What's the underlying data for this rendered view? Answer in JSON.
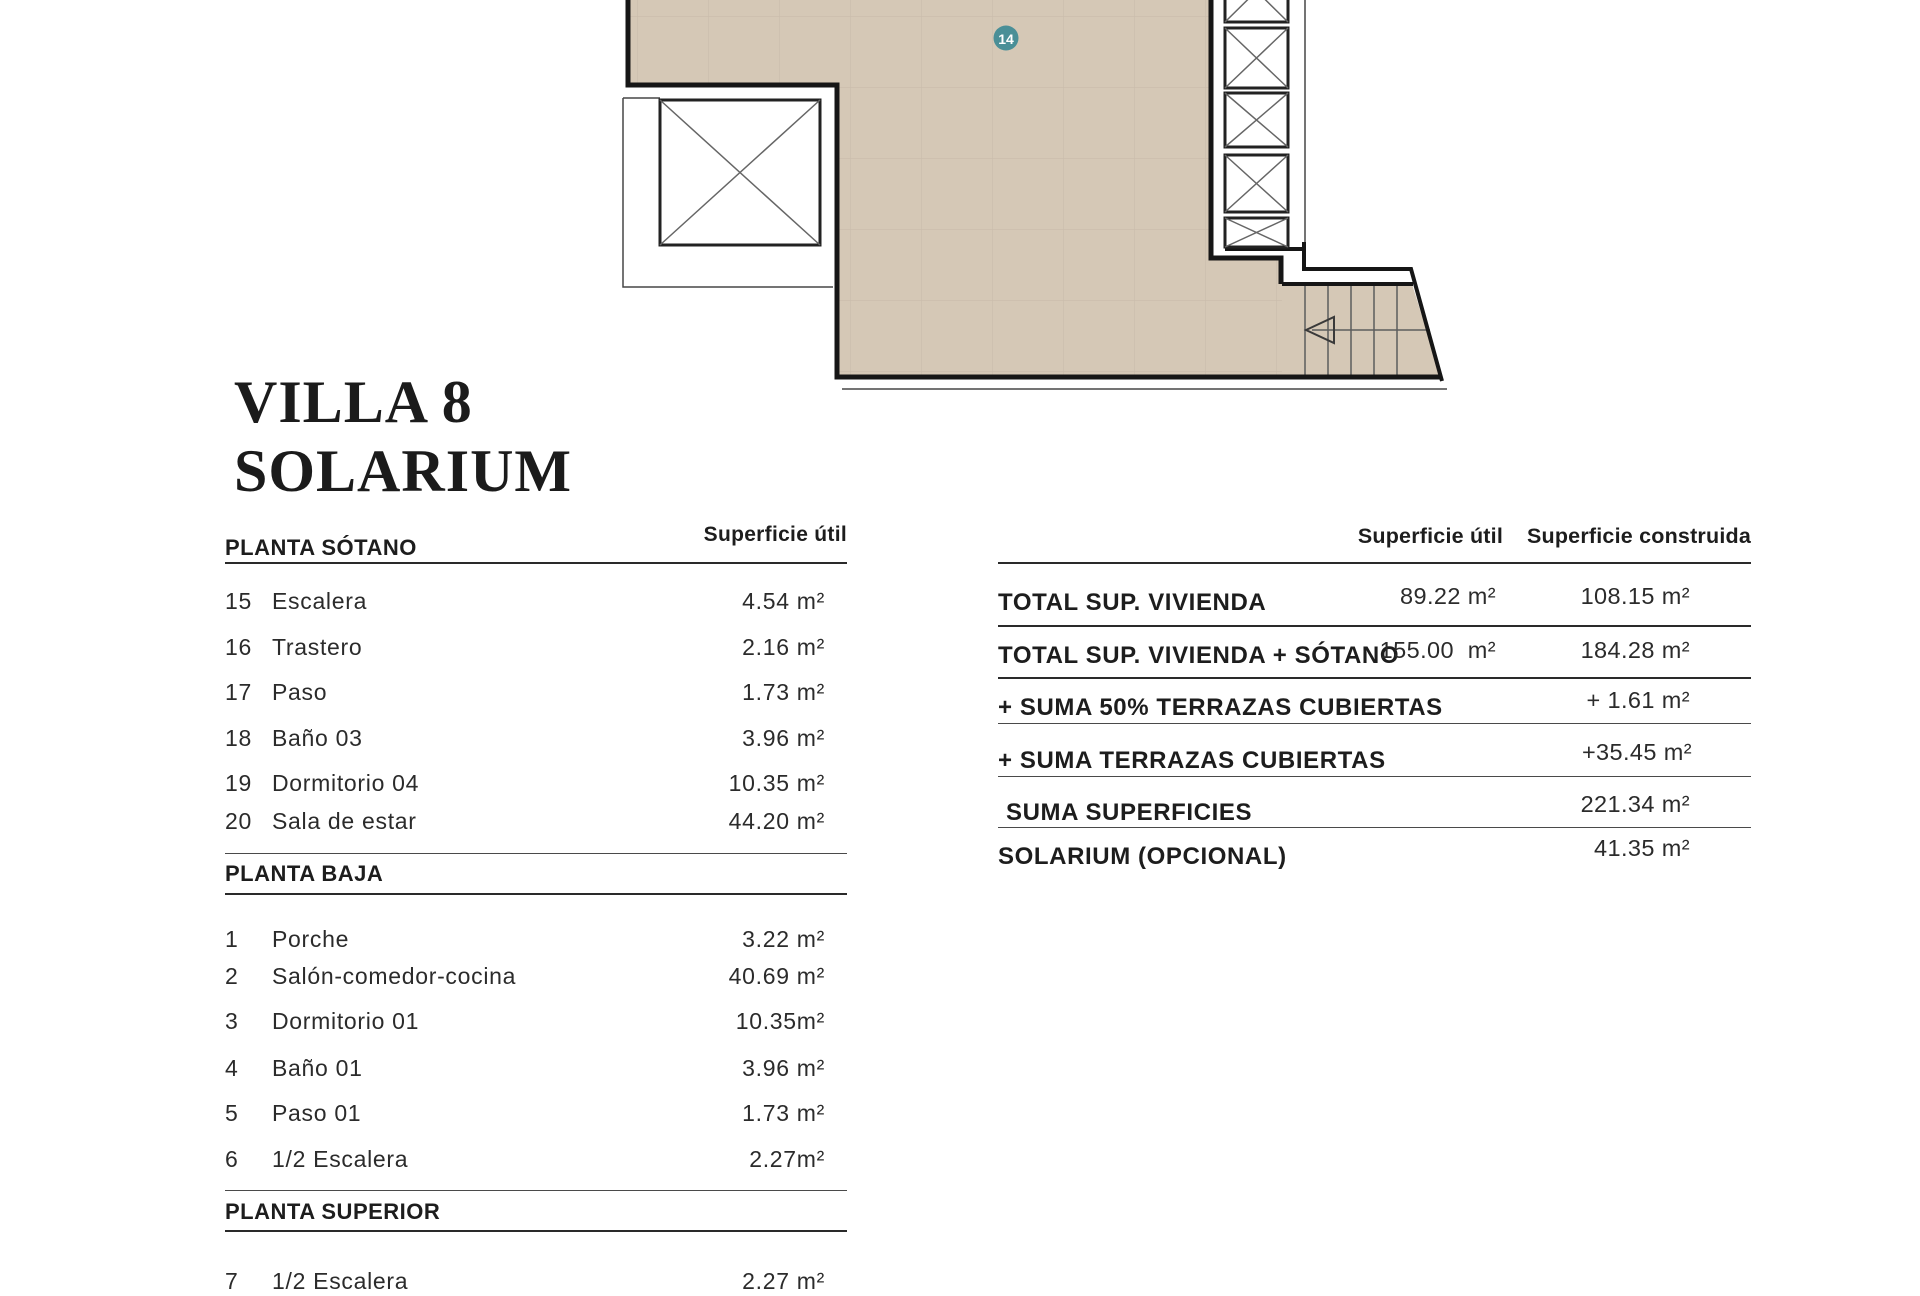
{
  "title": {
    "line1": "VILLA 8",
    "line2": "SOLARIUM"
  },
  "plan": {
    "marker_label": "14",
    "marker_color": "#4a8f97",
    "floor_color": "#d5c8b6",
    "grid_color": "#c9bcab",
    "wall_color": "#161616"
  },
  "left_table": {
    "header_col": "Superficie útil",
    "sections": [
      {
        "title": "PLANTA SÓTANO",
        "rows": [
          {
            "num": "15",
            "name": "Escalera",
            "value": "4.54 m²"
          },
          {
            "num": "16",
            "name": "Trastero",
            "value": "2.16 m²"
          },
          {
            "num": "17",
            "name": "Paso",
            "value": "1.73 m²"
          },
          {
            "num": "18",
            "name": "Baño 03",
            "value": "3.96 m²"
          },
          {
            "num": "19",
            "name": "Dormitorio 04",
            "value": "10.35 m²"
          },
          {
            "num": "20",
            "name": "Sala de estar",
            "value": "44.20 m²"
          }
        ]
      },
      {
        "title": "PLANTA BAJA",
        "rows": [
          {
            "num": "1",
            "name": "Porche",
            "value": "3.22 m²"
          },
          {
            "num": "2",
            "name": "Salón-comedor-cocina",
            "value": "40.69 m²"
          },
          {
            "num": "3",
            "name": "Dormitorio 01",
            "value": "10.35m²"
          },
          {
            "num": "4",
            "name": "Baño 01",
            "value": "3.96 m²"
          },
          {
            "num": "5",
            "name": "Paso 01",
            "value": "1.73 m²"
          },
          {
            "num": "6",
            "name": "1/2 Escalera",
            "value": "2.27m²"
          }
        ]
      },
      {
        "title": "PLANTA SUPERIOR",
        "rows": [
          {
            "num": "7",
            "name": "1/2 Escalera",
            "value": "2.27 m²"
          }
        ]
      }
    ]
  },
  "right_table": {
    "col1_header": "Superficie útil",
    "col2_header": "Superficie construida",
    "rows": [
      {
        "label": "TOTAL SUP. VIVIENDA",
        "util": "89.22 m²",
        "construida": "108.15 m²"
      },
      {
        "label": "TOTAL SUP. VIVIENDA + SÓTANO",
        "util": "155.00  m²",
        "construida": "184.28 m²"
      },
      {
        "label": "+ SUMA 50% TERRAZAS CUBIERTAS",
        "util": "",
        "construida": "+ 1.61 m²"
      },
      {
        "label": "+ SUMA TERRAZAS CUBIERTAS",
        "util": "",
        "construida": "+35.45 m²"
      },
      {
        "label": "SUMA SUPERFICIES",
        "util": "",
        "construida": "221.34 m²"
      },
      {
        "label": "SOLARIUM (OPCIONAL)",
        "util": "",
        "construida": "41.35 m²"
      }
    ]
  }
}
